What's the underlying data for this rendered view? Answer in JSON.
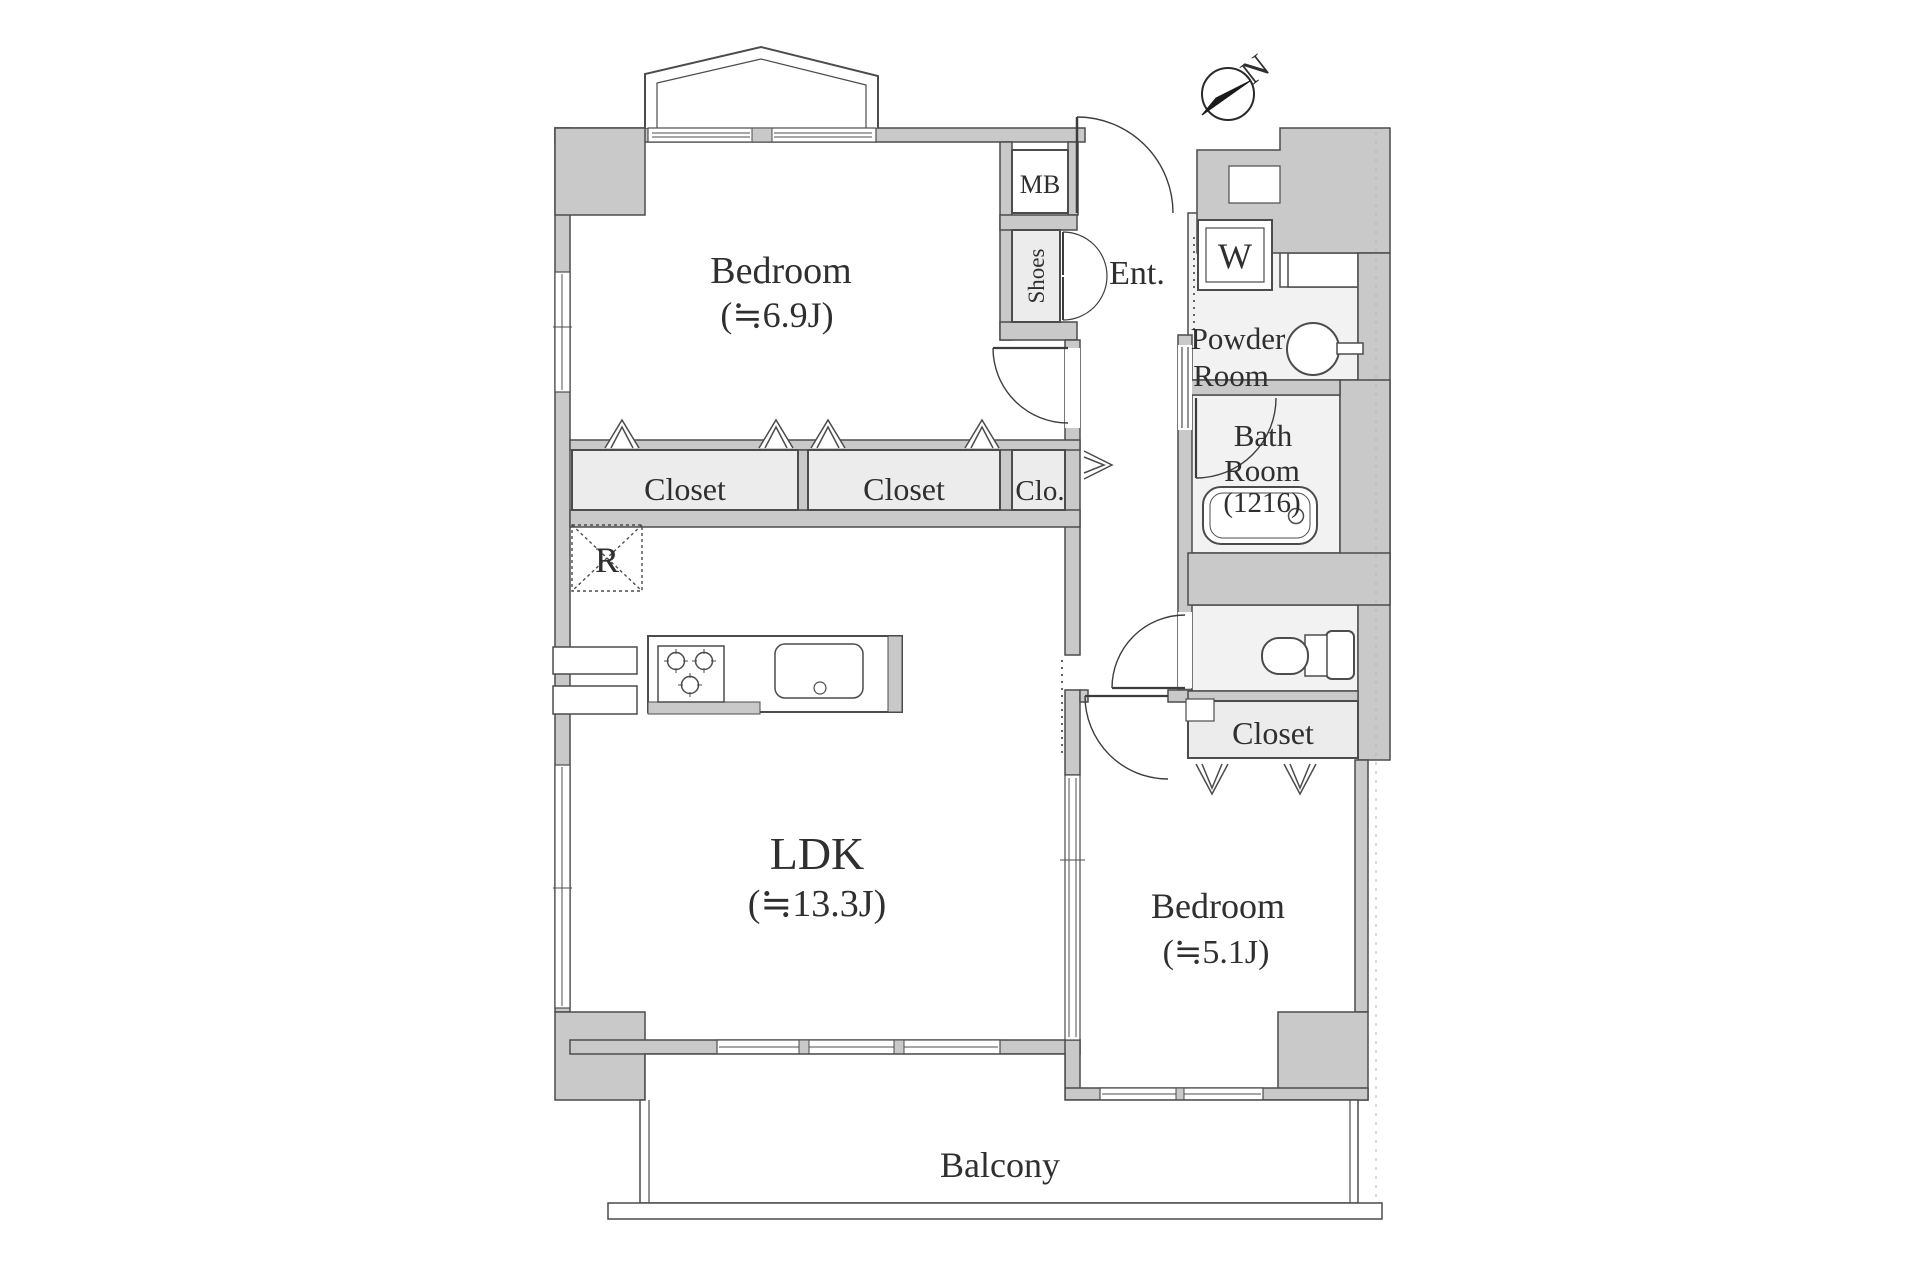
{
  "compass": {
    "north": "N"
  },
  "rooms": {
    "bedroom1": {
      "name": "Bedroom",
      "size": "(≒6.9J)"
    },
    "ldk": {
      "name": "LDK",
      "size": "(≒13.3J)"
    },
    "bedroom2": {
      "name": "Bedroom",
      "size": "(≒5.1J)"
    },
    "entrance": {
      "label": "Ent."
    },
    "powder": {
      "line1": "Powder",
      "line2": "Room"
    },
    "bath": {
      "line1": "Bath",
      "line2": "Room",
      "line3": "(1216)"
    },
    "balcony": {
      "label": "Balcony"
    }
  },
  "storage": {
    "closet_a": "Closet",
    "closet_b": "Closet",
    "clo": "Clo.",
    "closet_c": "Closet",
    "shoes": "Shoes",
    "meter_box": "MB",
    "washer": "W",
    "fridge": "R"
  },
  "colors": {
    "wall_fill": "#c9c9c9",
    "wall_stroke": "#4c4c4c",
    "room_fill": "#ffffff",
    "wet_floor_fill": "#f2f2f2",
    "storage_fill": "#ececec",
    "text": "#2f2f2f",
    "compass_needle": "#1a1a1a"
  }
}
